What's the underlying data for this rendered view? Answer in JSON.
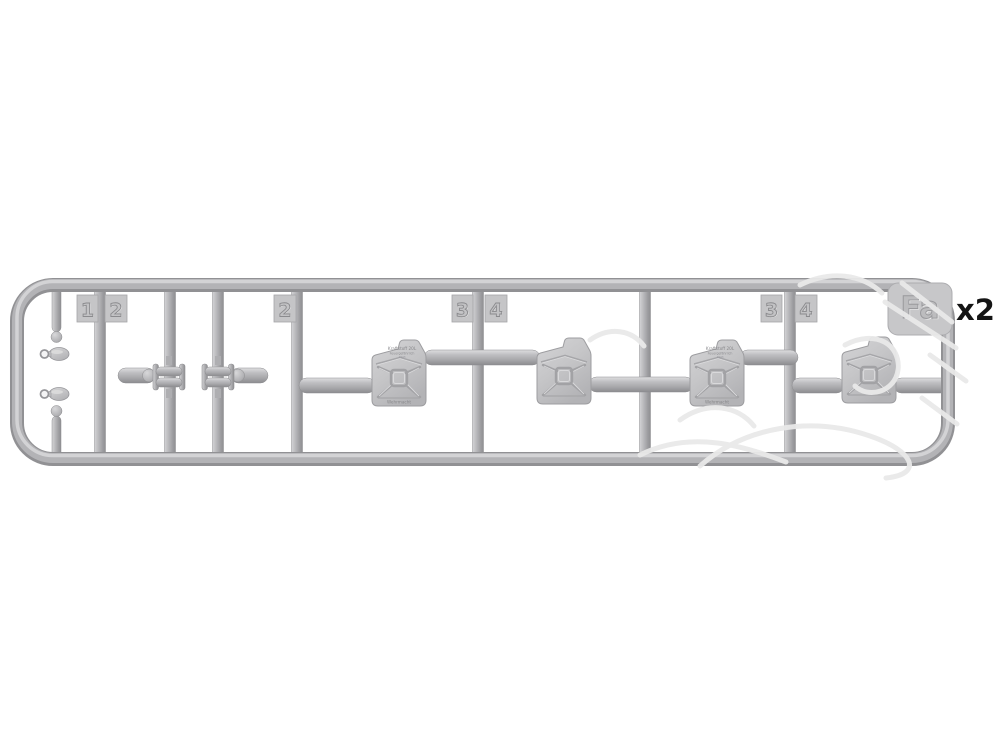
{
  "image": {
    "description": "Injection-molded plastic sprue (gate Fa) of a scale-model jerry can set on white background",
    "background_color": "#ffffff",
    "plastic_color": "#b4b4b6"
  },
  "sprue": {
    "gate_label": "Fa",
    "quantity_note": "x2",
    "part_tags": [
      "1",
      "2",
      "2",
      "3",
      "4",
      "3",
      "4"
    ]
  },
  "jerrycan_emboss": {
    "line1": "Kraftstoff 20L",
    "line2": "Feuergefährlich",
    "line3": "1943",
    "line4": "Wehrmacht"
  }
}
